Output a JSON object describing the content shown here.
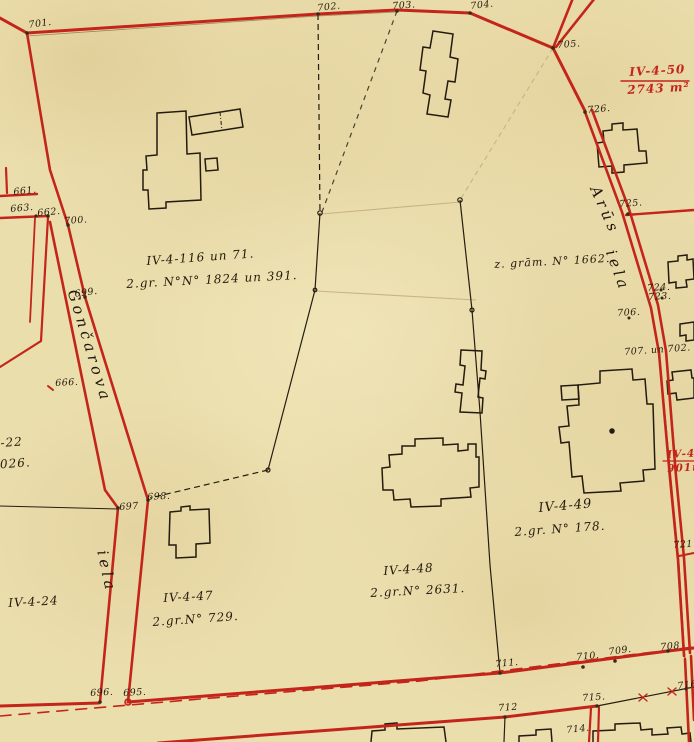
{
  "map": {
    "title": "cadastral-survey-map",
    "colors": {
      "paper": "#ebdead",
      "boundary_red": "#c3251b",
      "ink_black": "#241b0e",
      "pencil_faint": "#c6b484"
    },
    "streets": [
      "Gončarova iela",
      "Arūs iela"
    ],
    "labels": [
      {
        "name": "survey-point-701",
        "cls": "pt",
        "text": "701.",
        "x": 28,
        "y": 21,
        "rot": -8
      },
      {
        "name": "survey-point-702",
        "cls": "pt",
        "text": "702.",
        "x": 317,
        "y": 4,
        "rot": -6
      },
      {
        "name": "survey-point-703",
        "cls": "pt",
        "text": "703.",
        "x": 392,
        "y": 2,
        "rot": -4
      },
      {
        "name": "survey-point-704",
        "cls": "pt",
        "text": "704.",
        "x": 470,
        "y": 2,
        "rot": -6
      },
      {
        "name": "survey-point-705",
        "cls": "pt",
        "text": "705.",
        "x": 557,
        "y": 41,
        "rot": -4
      },
      {
        "name": "survey-point-726",
        "cls": "pt",
        "text": "726.",
        "x": 587,
        "y": 106,
        "rot": -5
      },
      {
        "name": "survey-point-725",
        "cls": "pt",
        "text": "725.",
        "x": 619,
        "y": 200,
        "rot": -4
      },
      {
        "name": "survey-point-724",
        "cls": "pt",
        "text": "724.",
        "x": 647,
        "y": 284,
        "rot": -3
      },
      {
        "name": "survey-point-723",
        "cls": "pt",
        "text": "723.",
        "x": 648,
        "y": 293,
        "rot": -3
      },
      {
        "name": "survey-point-706",
        "cls": "pt",
        "text": "706.",
        "x": 617,
        "y": 309,
        "rot": -3
      },
      {
        "name": "survey-point-707-702",
        "cls": "pt",
        "text": "707. un 702.",
        "x": 624,
        "y": 348,
        "rot": -4
      },
      {
        "name": "survey-point-661",
        "cls": "pt",
        "text": "661.",
        "x": 13,
        "y": 188,
        "rot": -6
      },
      {
        "name": "survey-point-663",
        "cls": "pt",
        "text": "663.",
        "x": 10,
        "y": 205,
        "rot": -5
      },
      {
        "name": "survey-point-662",
        "cls": "pt",
        "text": "662.",
        "x": 37,
        "y": 209,
        "rot": -5
      },
      {
        "name": "survey-point-700",
        "cls": "pt",
        "text": "700.",
        "x": 64,
        "y": 217,
        "rot": -4
      },
      {
        "name": "survey-point-699",
        "cls": "pt",
        "text": "699.",
        "x": 74,
        "y": 290,
        "rot": -8
      },
      {
        "name": "survey-point-666",
        "cls": "pt",
        "text": "666.",
        "x": 55,
        "y": 379,
        "rot": -3
      },
      {
        "name": "survey-point-697",
        "cls": "pt",
        "text": "697",
        "x": 119,
        "y": 503,
        "rot": -4
      },
      {
        "name": "survey-point-698",
        "cls": "pt",
        "text": "698.",
        "x": 147,
        "y": 493,
        "rot": -3
      },
      {
        "name": "survey-point-696",
        "cls": "pt",
        "text": "696.",
        "x": 90,
        "y": 689,
        "rot": -3
      },
      {
        "name": "survey-point-695",
        "cls": "pt",
        "text": "695.",
        "x": 123,
        "y": 689,
        "rot": -3
      },
      {
        "name": "survey-point-711",
        "cls": "pt",
        "text": "711.",
        "x": 495,
        "y": 660,
        "rot": -5
      },
      {
        "name": "survey-point-710",
        "cls": "pt",
        "text": "710.",
        "x": 576,
        "y": 653,
        "rot": -5
      },
      {
        "name": "survey-point-709",
        "cls": "pt",
        "text": "709.",
        "x": 608,
        "y": 648,
        "rot": -8
      },
      {
        "name": "survey-point-708",
        "cls": "pt",
        "text": "708",
        "x": 660,
        "y": 643,
        "rot": -5
      },
      {
        "name": "survey-point-712",
        "cls": "pt",
        "text": "712",
        "x": 498,
        "y": 704,
        "rot": -4
      },
      {
        "name": "survey-point-715",
        "cls": "pt",
        "text": "715.",
        "x": 582,
        "y": 694,
        "rot": -4
      },
      {
        "name": "survey-point-714",
        "cls": "pt",
        "text": "714.",
        "x": 566,
        "y": 726,
        "rot": -6
      },
      {
        "name": "survey-point-716",
        "cls": "pt",
        "text": "716.",
        "x": 677,
        "y": 682,
        "rot": -6
      },
      {
        "name": "survey-point-721",
        "cls": "pt",
        "text": "721.",
        "x": 673,
        "y": 541,
        "rot": -4
      },
      {
        "name": "parcel-label-iv-4-116",
        "cls": "region",
        "text": "IV-4-116 un 71.",
        "x": 146,
        "y": 255,
        "size": 12,
        "rot": -4
      },
      {
        "name": "parcel-label-gr-1824",
        "cls": "region",
        "text": "2.gr. N°N° 1824 un 391.",
        "x": 126,
        "y": 278,
        "size": 12,
        "rot": -3
      },
      {
        "name": "parcel-label-zgram-1662",
        "cls": "region",
        "text": "z. grām. N° 1662.",
        "x": 494,
        "y": 259,
        "size": 11,
        "rot": -3
      },
      {
        "name": "parcel-label-iv-4-49",
        "cls": "region",
        "text": "IV-4-49",
        "x": 538,
        "y": 502,
        "size": 13,
        "rot": -5
      },
      {
        "name": "parcel-label-gr-178",
        "cls": "region",
        "text": "2.gr. N° 178.",
        "x": 514,
        "y": 526,
        "size": 12,
        "rot": -4
      },
      {
        "name": "parcel-label-iv-4-48",
        "cls": "region",
        "text": "IV-4-48",
        "x": 383,
        "y": 565,
        "size": 12,
        "rot": -4
      },
      {
        "name": "parcel-label-gr-2631",
        "cls": "region",
        "text": "2.gr.N° 2631.",
        "x": 370,
        "y": 587,
        "size": 12,
        "rot": -3
      },
      {
        "name": "parcel-label-iv-4-47",
        "cls": "region",
        "text": "IV-4-47",
        "x": 163,
        "y": 592,
        "size": 12,
        "rot": -3
      },
      {
        "name": "parcel-label-gr-729",
        "cls": "region",
        "text": "2.gr.N° 729.",
        "x": 152,
        "y": 616,
        "size": 12,
        "rot": -4
      },
      {
        "name": "parcel-label-iv-4-24",
        "cls": "region",
        "text": "IV-4-24",
        "x": 8,
        "y": 597,
        "size": 12,
        "rot": -3
      },
      {
        "name": "parcel-label-22-partial",
        "cls": "region",
        "text": "-22",
        "x": 0,
        "y": 437,
        "size": 12,
        "rot": -4
      },
      {
        "name": "parcel-label-3026-partial",
        "cls": "region",
        "text": "3026.",
        "x": -9,
        "y": 459,
        "size": 12,
        "rot": -4
      },
      {
        "name": "street-name-goncarova",
        "cls": "street",
        "text": "Gončarova",
        "x": 79,
        "y": 288,
        "rot": 73
      },
      {
        "name": "street-name-iela-left",
        "cls": "street",
        "text": "iela",
        "x": 109,
        "y": 549,
        "rot": 78
      },
      {
        "name": "street-name-arus",
        "cls": "street",
        "text": "Arūs",
        "x": 601,
        "y": 184,
        "rot": 66
      },
      {
        "name": "street-name-iela-right",
        "cls": "street",
        "text": "iela",
        "x": 617,
        "y": 248,
        "rot": 70
      },
      {
        "name": "red-label-iv-4-50",
        "cls": "red",
        "text": "IV-4-50",
        "x": 629,
        "y": 66,
        "size": 12,
        "rot": -3
      },
      {
        "name": "red-label-2743-m2",
        "cls": "red",
        "text": "2743 m²",
        "x": 627,
        "y": 84,
        "size": 12,
        "rot": -3
      },
      {
        "name": "red-label-iv-4-partial",
        "cls": "red",
        "text": "IV-4-",
        "x": 667,
        "y": 450,
        "size": 10.5,
        "rot": -3
      },
      {
        "name": "red-label-901m-partial",
        "cls": "red",
        "text": "901m",
        "x": 667,
        "y": 464,
        "size": 10.5,
        "rot": -3
      }
    ]
  }
}
